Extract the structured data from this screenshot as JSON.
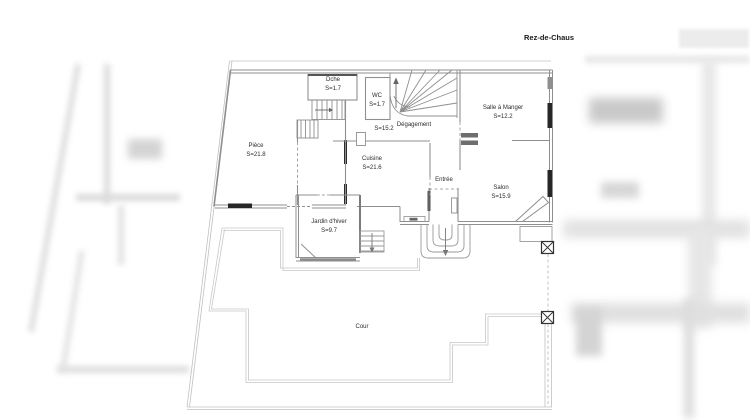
{
  "title": "Rez-de-Chaus",
  "floor_plan": {
    "rooms": [
      {
        "id": "dche",
        "name": "Dche",
        "area": "S=1.7"
      },
      {
        "id": "wc",
        "name": "WC",
        "area": "S=1.7"
      },
      {
        "id": "degagement",
        "name": "Dégagement",
        "area": "S=15.2"
      },
      {
        "id": "salle-a-manger",
        "name": "Salle à Manger",
        "area": "S=12.2"
      },
      {
        "id": "piece",
        "name": "Pièce",
        "area": "S=21.8"
      },
      {
        "id": "cuisine",
        "name": "Cuisine",
        "area": "S=21.6"
      },
      {
        "id": "entree",
        "name": "Entrée",
        "area": ""
      },
      {
        "id": "salon",
        "name": "Salon",
        "area": "S=15.9"
      },
      {
        "id": "jardin-dhiver",
        "name": "Jardin d'hiver",
        "area": "S=9.7"
      },
      {
        "id": "cour",
        "name": "Cour",
        "area": ""
      }
    ],
    "colors": {
      "wall": "#8f8f8f",
      "window": "#262626",
      "parcel_boundary": "#c0c0c0",
      "terrace_edge": "#c8c8c8",
      "label_text": "#2b2b2b"
    }
  }
}
